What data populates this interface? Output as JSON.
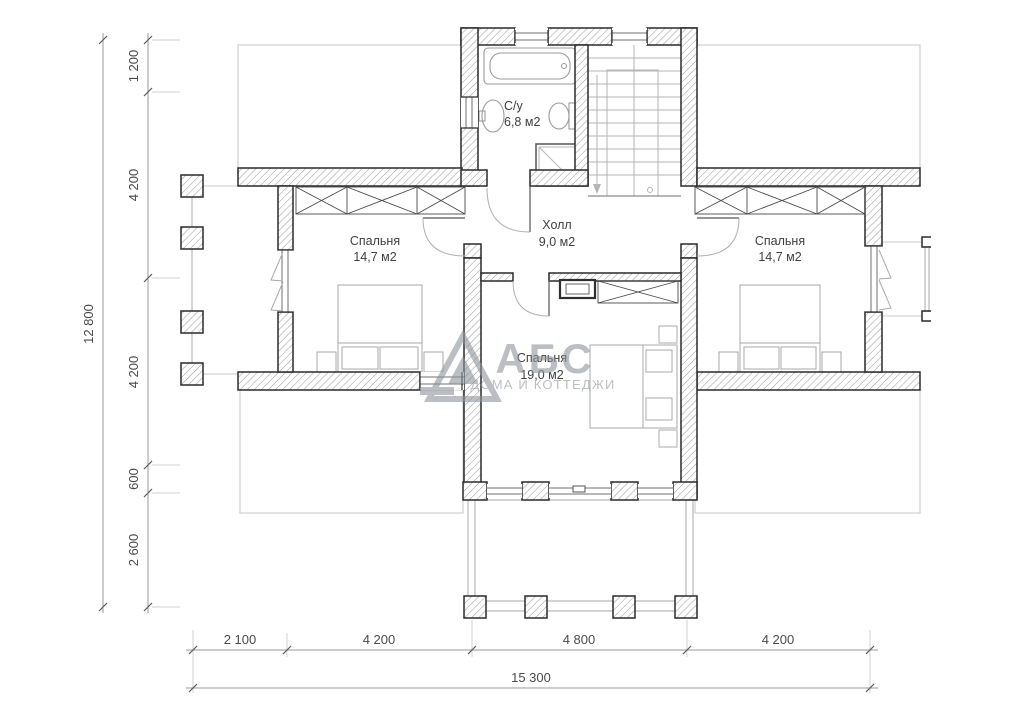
{
  "watermark": {
    "brand": "АБС",
    "tagline": "ДОМА И КОТТЕДЖИ"
  },
  "rooms": {
    "bathroom": {
      "name": "С/у",
      "area": "6,8 м2"
    },
    "hall": {
      "name": "Холл",
      "area": "9,0 м2"
    },
    "bedroom_left": {
      "name": "Спальня",
      "area": "14,7 м2"
    },
    "bedroom_center": {
      "name": "Спальня",
      "area": "19,0 м2"
    },
    "bedroom_right": {
      "name": "Спальня",
      "area": "14,7 м2"
    }
  },
  "dimensions": {
    "left": {
      "segments": [
        "1 200",
        "4 200",
        "4 200",
        "600",
        "2 600"
      ],
      "total": "12 800"
    },
    "bottom": {
      "segments": [
        "2 100",
        "4 200",
        "4 800",
        "4 200"
      ],
      "total": "15 300"
    }
  },
  "colors": {
    "wall_outline": "#2a2a2a",
    "hatch": "#9f9f9f",
    "watermark": "#8f939b",
    "dimension_text": "#4a4a4a"
  }
}
